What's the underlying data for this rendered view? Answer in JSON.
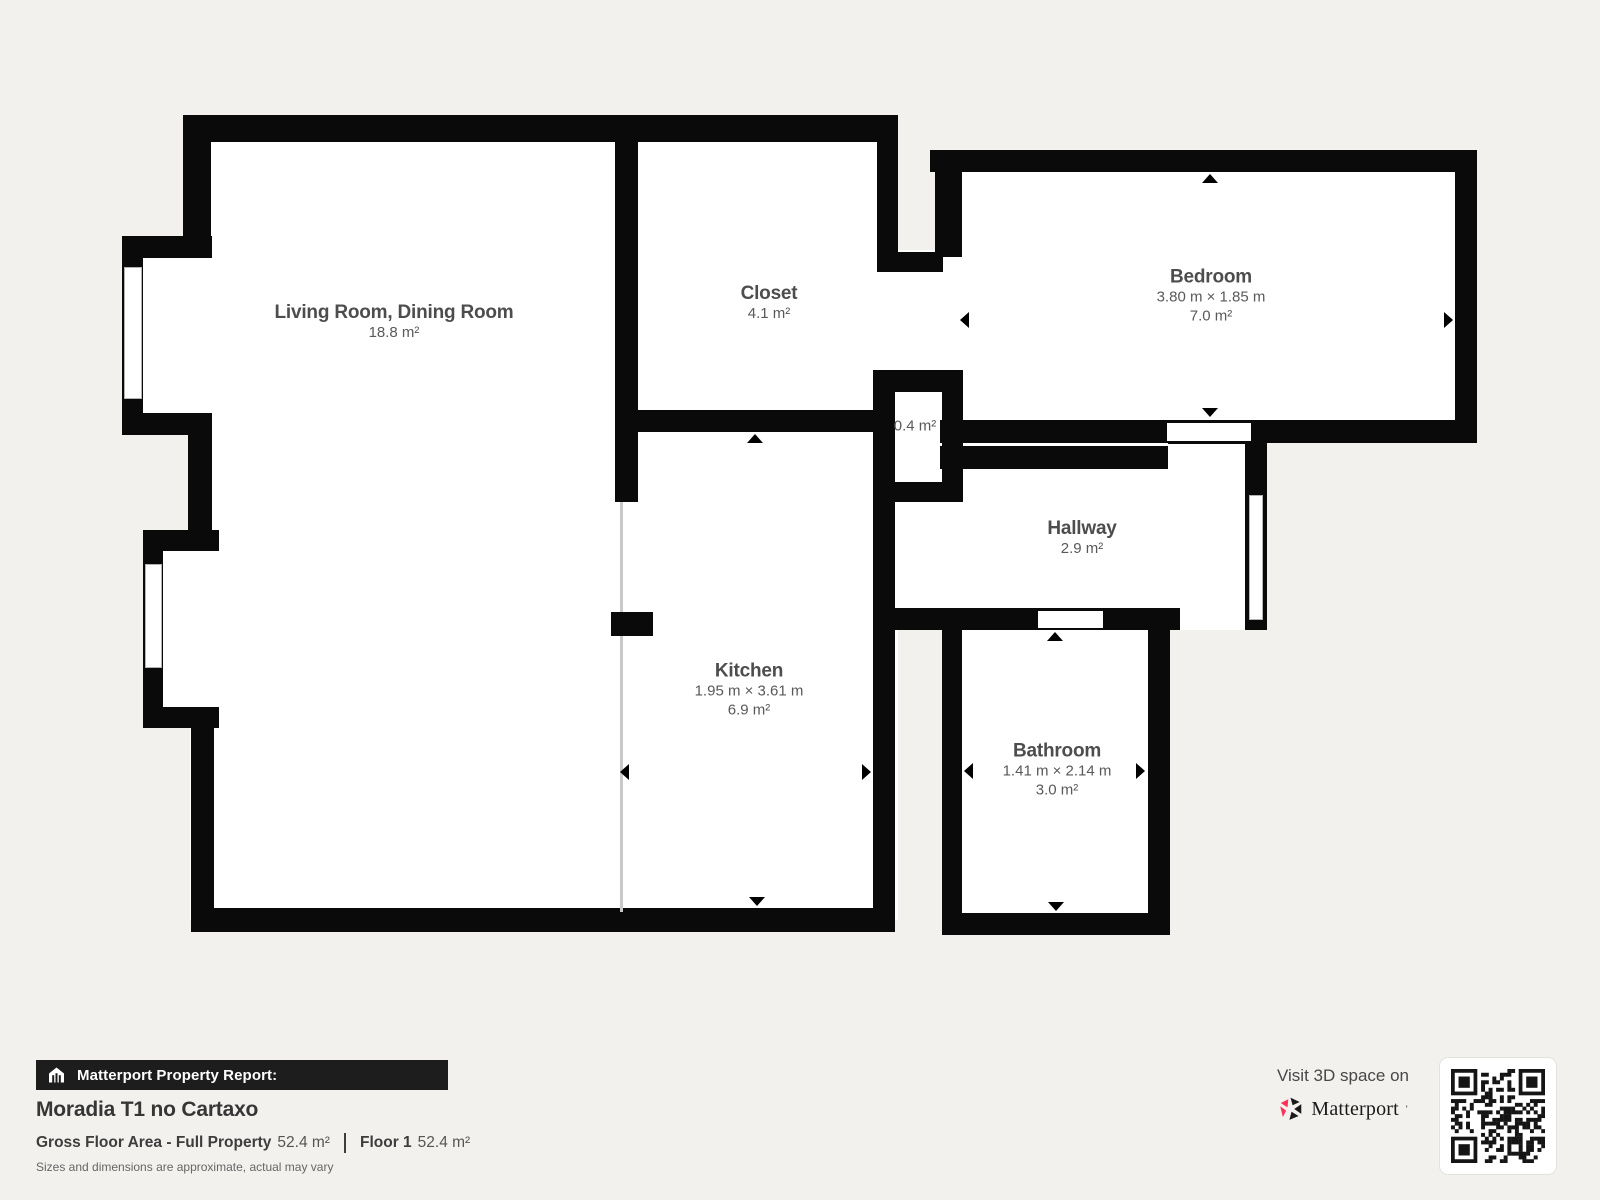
{
  "page": {
    "background": "#f2f1ee",
    "wall_color": "#0a0a0a",
    "floor_color": "#ffffff"
  },
  "rooms": {
    "living_room": {
      "name": "Living Room, Dining Room",
      "area": "18.8 m²"
    },
    "closet": {
      "name": "Closet",
      "area": "4.1 m²"
    },
    "bedroom": {
      "name": "Bedroom",
      "dims": "3.80 m × 1.85 m",
      "area": "7.0 m²"
    },
    "small_space": {
      "area": "0.4 m²"
    },
    "hallway": {
      "name": "Hallway",
      "area": "2.9 m²"
    },
    "kitchen": {
      "name": "Kitchen",
      "dims": "1.95 m × 3.61 m",
      "area": "6.9 m²"
    },
    "bathroom": {
      "name": "Bathroom",
      "dims": "1.41 m × 2.14 m",
      "area": "3.0 m²"
    }
  },
  "report": {
    "bar_label": "Matterport Property Report:",
    "property_name": "Moradia T1 no Cartaxo",
    "gross_label": "Gross Floor Area - Full Property",
    "gross_value": "52.4 m²",
    "floor_label": "Floor 1",
    "floor_value": "52.4 m²",
    "disclaimer": "Sizes and dimensions are approximate, actual may vary"
  },
  "cta": {
    "visit_text": "Visit 3D space on",
    "brand": "Matterport",
    "logo_red": "#ff3158",
    "logo_black": "#1a1a1a"
  }
}
